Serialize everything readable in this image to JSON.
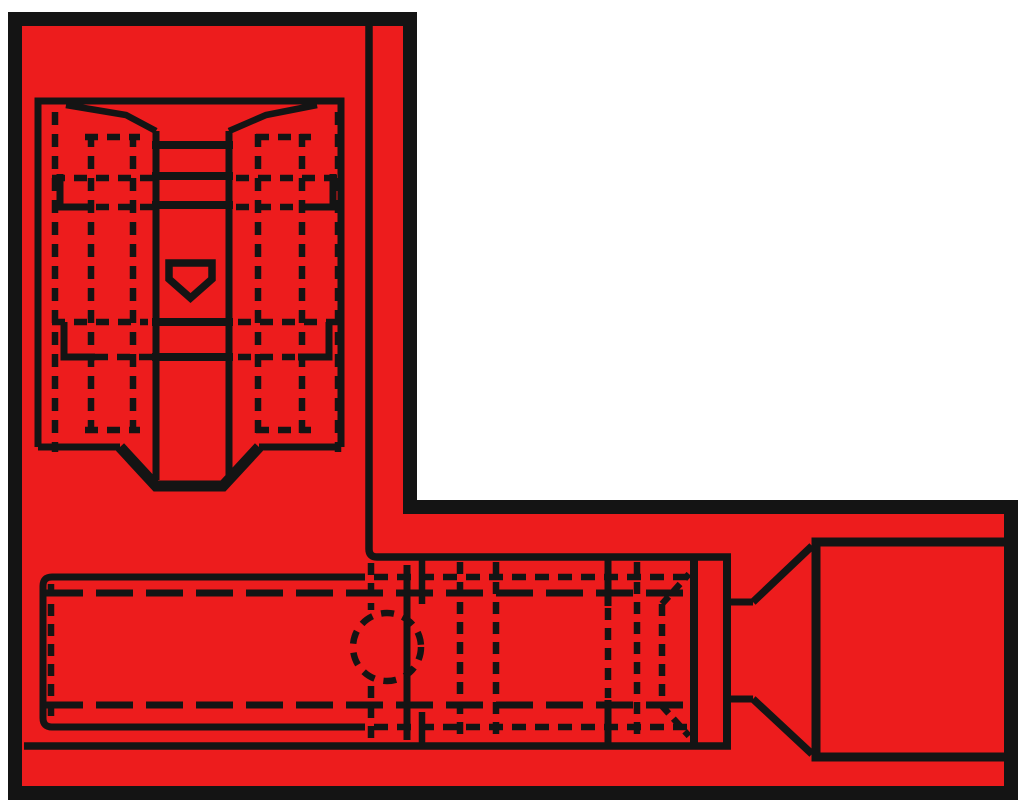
{
  "colors": {
    "background": "#ffffff",
    "insulation_red": "#ED1C1D",
    "line_ink": "#141414"
  },
  "drawing": {
    "canvas": {
      "w": 1024,
      "h": 804
    },
    "outline": {
      "name": "insulation-body-outline",
      "d": "M 15,19 H 410 V 507 H 1011 V 793 H 15 Z",
      "w": 14
    },
    "solid": [
      {
        "n": "receptacle-housing-rect",
        "d": "M 38,447 V 101 H 341 V 447",
        "w": 7
      },
      {
        "n": "housing-bottom-edge-left",
        "d": "M 38,447 H 120",
        "w": 7
      },
      {
        "n": "housing-bottom-edge-right",
        "d": "M 259,447 H 341",
        "w": 7
      },
      {
        "n": "mouth-notch",
        "d": "M 120,447 L 156,486 H 223 L 259,447",
        "w": 11
      },
      {
        "n": "contact-channel-left",
        "d": "M 156,131 V 480",
        "w": 7
      },
      {
        "n": "contact-channel-right",
        "d": "M 229,131 V 480",
        "w": 7
      },
      {
        "n": "channel-taper-left",
        "d": "M 66,105 L 126,115 L 156,131",
        "w": 6.5
      },
      {
        "n": "channel-taper-right",
        "d": "M 317,105 L 266,115 L 229,131",
        "w": 6.5
      },
      {
        "n": "channel-bar-1",
        "d": "M 152,145 H 233",
        "w": 8
      },
      {
        "n": "channel-bar-2",
        "d": "M 152,176 H 233",
        "w": 8
      },
      {
        "n": "channel-bar-3",
        "d": "M 152,205 H 233",
        "w": 8
      },
      {
        "n": "channel-bar-4",
        "d": "M 152,322 H 233",
        "w": 8
      },
      {
        "n": "channel-bar-5",
        "d": "M 152,357 H 233",
        "w": 8
      },
      {
        "n": "detent-dimple",
        "d": "M 169,263 H 212 V 279 L 190.5,298 L 169,279 Z",
        "w": 7.5
      },
      {
        "n": "spring-step-upper-left",
        "d": "M 60,174 V 207 H 91",
        "w": 7
      },
      {
        "n": "spring-step-upper-right",
        "d": "M 333,174 V 207 H 302",
        "w": 7
      },
      {
        "n": "spring-step-lower-left",
        "d": "M 64,322 V 357 H 95",
        "w": 7
      },
      {
        "n": "spring-step-lower-right",
        "d": "M 329,322 V 357 H 298",
        "w": 7
      },
      {
        "n": "flag-body-edge",
        "d": "M 369,25 V 549 Q 369,557 377,557 H 731",
        "w": 7.5
      },
      {
        "n": "crimp-barrel",
        "d": "M 365,577 H 52 Q 43,577 43,586 V 718 Q 43,727 52,727 H 365",
        "w": 7
      },
      {
        "n": "barrel-end-wall",
        "d": "M 407,565 V 740",
        "w": 7
      },
      {
        "n": "sleeve-bottom-edge",
        "d": "M 24,746 H 731",
        "w": 7.5
      },
      {
        "n": "sleeve-joint-upper",
        "d": "M 422,556 V 604",
        "w": 6.5
      },
      {
        "n": "sleeve-joint-lower",
        "d": "M 422,712 V 747",
        "w": 6.5
      },
      {
        "n": "seam-solid-top",
        "d": "M 608,557 V 606",
        "w": 7
      },
      {
        "n": "seam-solid-bottom",
        "d": "M 608,700 V 746",
        "w": 7
      },
      {
        "n": "collar-left-edge",
        "d": "M 694,555 V 748",
        "w": 8
      },
      {
        "n": "collar-right-edge",
        "d": "M 727,555 V 748",
        "w": 8
      },
      {
        "n": "funnel-neck-top",
        "d": "M 727,602 H 753",
        "w": 7
      },
      {
        "n": "funnel-neck-bottom",
        "d": "M 727,699 H 753",
        "w": 7
      },
      {
        "n": "funnel-flare-top",
        "d": "M 753,602 L 812,546",
        "w": 7.5
      },
      {
        "n": "funnel-flare-bottom",
        "d": "M 753,699 L 812,754",
        "w": 7.5
      },
      {
        "n": "tab-blade-rect",
        "d": "M 1014,542 H 816 V 757 H 1014",
        "w": 9
      }
    ],
    "dashed": [
      {
        "n": "hidden-col-left-1",
        "d": "M 55,112 V 452",
        "w": 6.5,
        "dash": "13 9"
      },
      {
        "n": "hidden-col-left-2",
        "d": "M 91,134 V 434",
        "w": 6.5,
        "dash": "13 9"
      },
      {
        "n": "hidden-col-left-3",
        "d": "M 133,134 V 434",
        "w": 6.5,
        "dash": "13 9"
      },
      {
        "n": "hidden-col-right-1",
        "d": "M 338,112 V 452",
        "w": 6.5,
        "dash": "13 9"
      },
      {
        "n": "hidden-col-right-2",
        "d": "M 302,134 V 434",
        "w": 6.5,
        "dash": "13 9"
      },
      {
        "n": "hidden-col-right-3",
        "d": "M 258,134 V 434",
        "w": 6.5,
        "dash": "13 9"
      },
      {
        "n": "hidden-row-137-left",
        "d": "M 85,137 H 140",
        "w": 6.5,
        "dash": "13 9"
      },
      {
        "n": "hidden-row-137-right",
        "d": "M 256,137 H 311",
        "w": 6.5,
        "dash": "13 9"
      },
      {
        "n": "hidden-row-178-left",
        "d": "M 52,178 H 153",
        "w": 6.5,
        "dash": "13 9"
      },
      {
        "n": "hidden-row-178-right",
        "d": "M 236,178 H 338",
        "w": 6.5,
        "dash": "13 9"
      },
      {
        "n": "hidden-row-207-left",
        "d": "M 96,207 H 153",
        "w": 6.5,
        "dash": "13 9"
      },
      {
        "n": "hidden-row-207-right",
        "d": "M 236,207 H 299",
        "w": 6.5,
        "dash": "13 9"
      },
      {
        "n": "hidden-row-322-left",
        "d": "M 52,322 H 148",
        "w": 6.5,
        "dash": "13 9"
      },
      {
        "n": "hidden-row-322-right",
        "d": "M 238,322 H 338",
        "w": 6.5,
        "dash": "13 9"
      },
      {
        "n": "hidden-row-357-left",
        "d": "M 95,357 H 153",
        "w": 6.5,
        "dash": "13 9"
      },
      {
        "n": "hidden-row-357-right",
        "d": "M 238,357 H 298",
        "w": 6.5,
        "dash": "13 9"
      },
      {
        "n": "hidden-row-430-left",
        "d": "M 85,430 H 140",
        "w": 6.5,
        "dash": "13 9"
      },
      {
        "n": "hidden-row-430-right",
        "d": "M 256,430 H 311",
        "w": 6.5,
        "dash": "13 9"
      },
      {
        "n": "wire-line-top",
        "d": "M 46,593 H 690",
        "w": 7,
        "dash": "37 13"
      },
      {
        "n": "wire-line-bottom",
        "d": "M 46,705 H 690",
        "w": 7,
        "dash": "37 13"
      },
      {
        "n": "barrel-hidden-top",
        "d": "M 374,577 H 688",
        "w": 6.5,
        "dash": "14 9"
      },
      {
        "n": "barrel-hidden-bottom",
        "d": "M 374,727 H 688",
        "w": 6.5,
        "dash": "14 9"
      },
      {
        "n": "barrel-end-hidden",
        "d": "M 51,584 V 721",
        "w": 6.5,
        "dash": "12 8"
      },
      {
        "n": "flag-edge-hidden-upper",
        "d": "M 371,563 V 610",
        "w": 6.5,
        "dash": "12 8"
      },
      {
        "n": "flag-edge-hidden-lower",
        "d": "M 371,686 V 740",
        "w": 6.5,
        "dash": "12 8"
      },
      {
        "n": "sleeve-rib-1",
        "d": "M 460,562 V 742",
        "w": 6.5,
        "dash": "12 8"
      },
      {
        "n": "sleeve-rib-2",
        "d": "M 496,562 V 742",
        "w": 6.5,
        "dash": "12 8"
      },
      {
        "n": "seam-hidden-mid",
        "d": "M 608,608 V 698",
        "w": 6.5,
        "dash": "12 8"
      },
      {
        "n": "sleeve-rib-3",
        "d": "M 637,562 V 742",
        "w": 6.5,
        "dash": "12 8"
      },
      {
        "n": "sleeve-bell-col",
        "d": "M 662,604 V 706",
        "w": 6.5,
        "dash": "12 8"
      },
      {
        "n": "sleeve-bell-flare-top",
        "d": "M 662,604 L 689,574",
        "w": 6.5,
        "dash": "10 7"
      },
      {
        "n": "sleeve-bell-flare-bottom",
        "d": "M 662,706 L 689,736",
        "w": 6.5,
        "dash": "10 7"
      }
    ],
    "inspection_hole": {
      "cx": 387,
      "cy": 647,
      "r": 34,
      "w": 6.5,
      "dash": "13 9"
    }
  }
}
